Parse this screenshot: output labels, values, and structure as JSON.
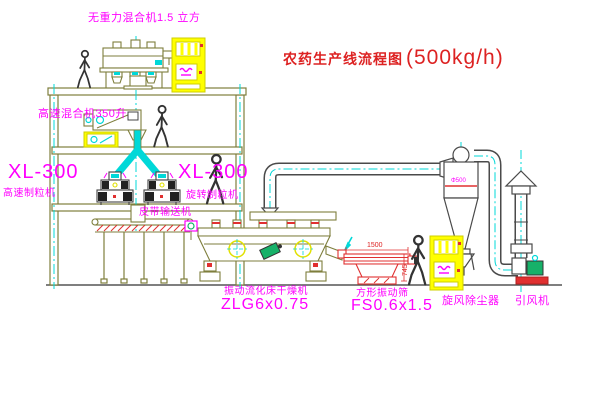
{
  "page": {
    "width": 600,
    "height": 403,
    "background": "#ffffff"
  },
  "title": {
    "text": "农药生产线流程图",
    "capacity": "(500kg/h)",
    "color": "#dd2222"
  },
  "labels": {
    "gravity_mixer": "无重力混合机1.5 立方",
    "high_speed_mixer": "高速混合机350升",
    "xl300_left_model": "XL-300",
    "xl300_left_name": "高速制粒机",
    "xl300_mid_model": "XL-300",
    "xl300_mid_name": "旋转制粒机",
    "belt_conveyor": "皮带输送机",
    "dryer_name": "振动流化床干燥机",
    "dryer_model": "ZLG6x0.75",
    "sieve_name": "方形振动筛",
    "sieve_model": "FS0.6x1.5",
    "cyclone": "旋风除尘器",
    "fan": "引风机"
  },
  "dimensions": {
    "sieve_width": "1500",
    "sieve_height": "745",
    "cyclone_note": "Φ500"
  },
  "colors": {
    "structure_olive": "#7e7e3c",
    "pipe_dark": "#4a4a4a",
    "centerline_cyan": "#00d8d8",
    "label_magenta": "#ff00ff",
    "title_red": "#dd2222",
    "cabinet_yellow": "#ffff00",
    "motor_green": "#17b169",
    "accent_red": "#e03030"
  }
}
